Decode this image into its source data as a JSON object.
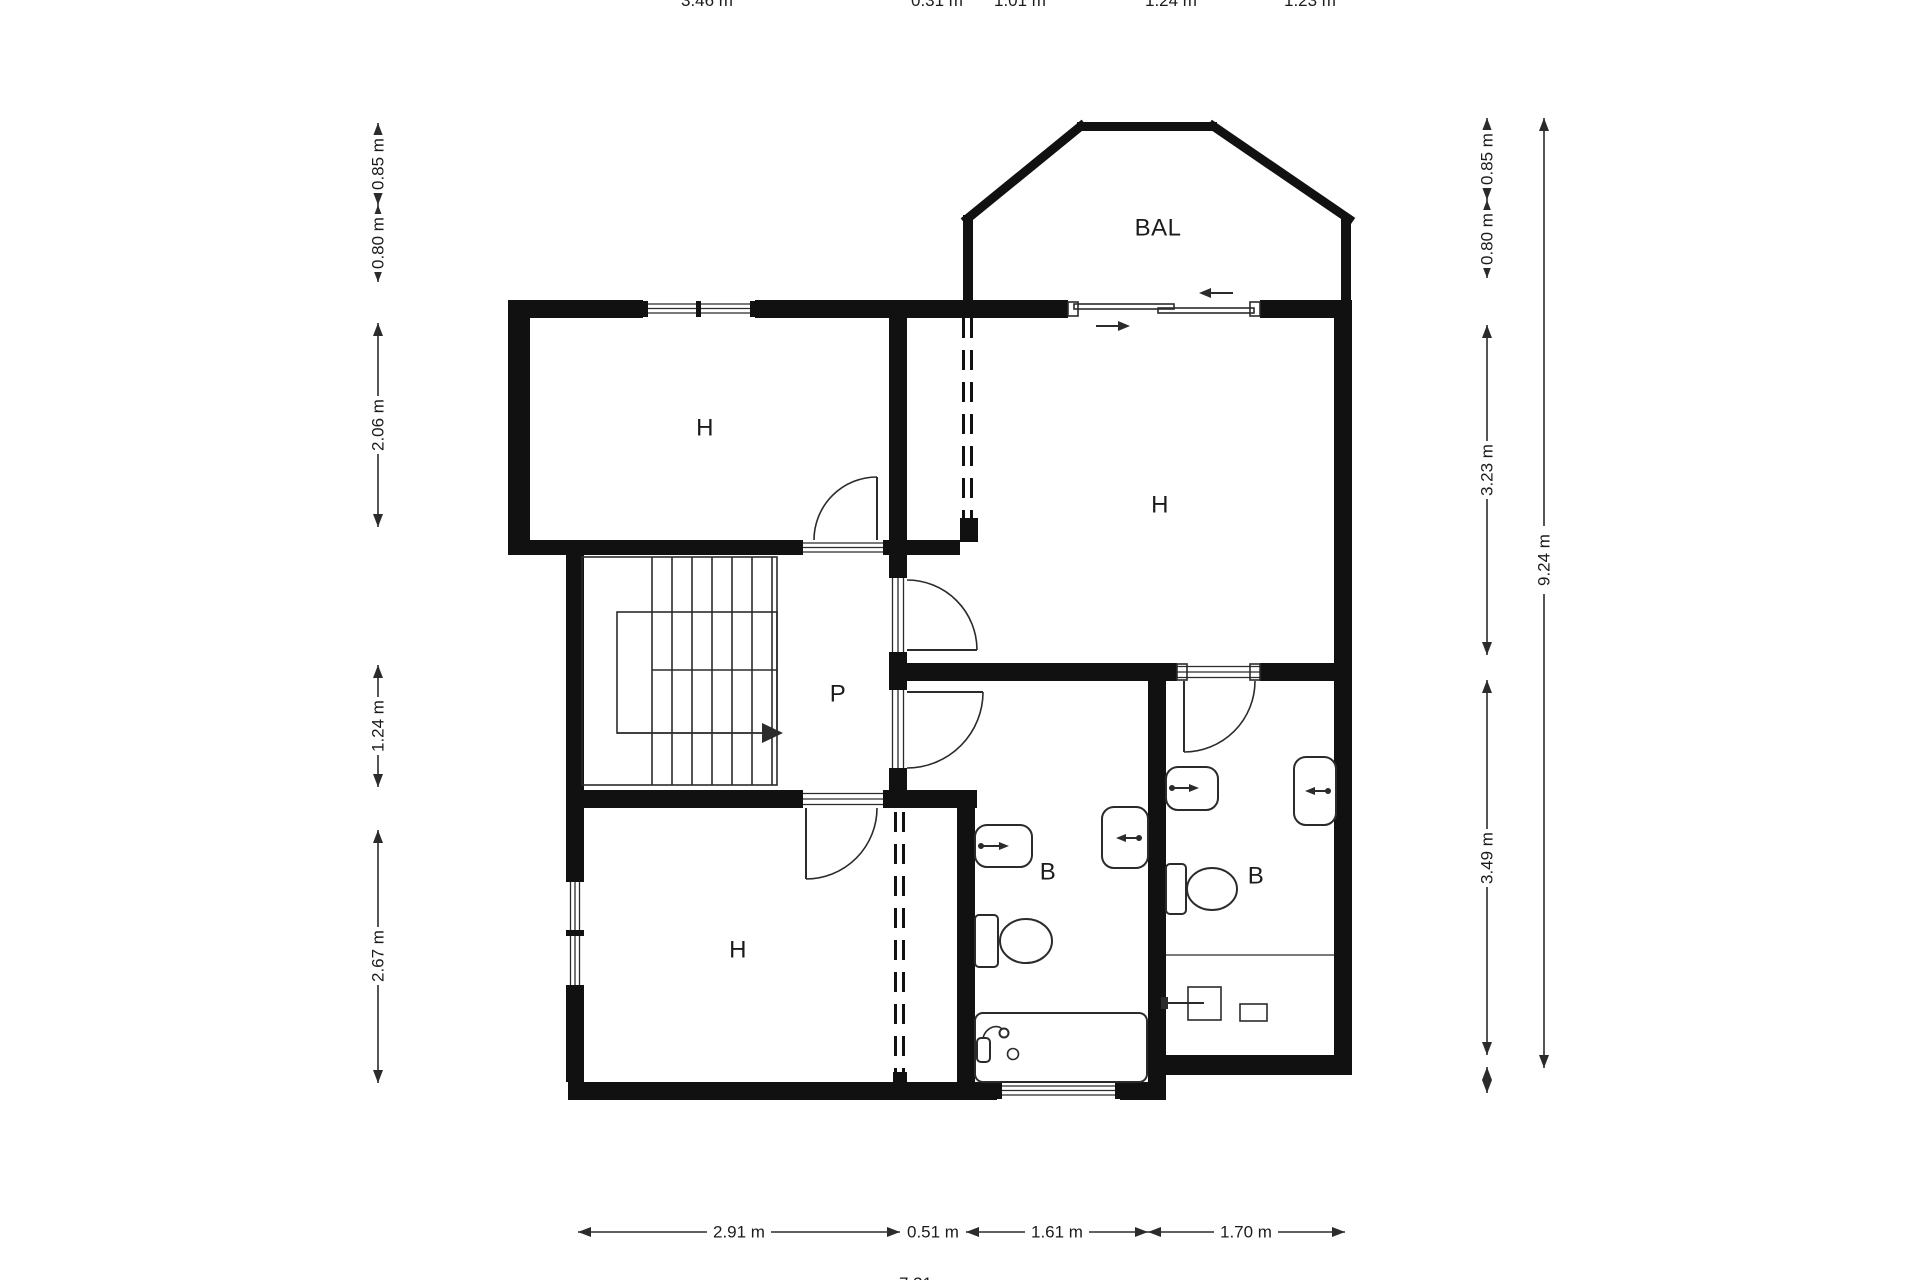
{
  "plan": {
    "rooms": {
      "balcony": "BAL",
      "bedroom_top_left": "H",
      "bedroom_top_right": "H",
      "bedroom_bottom": "H",
      "hallway": "P",
      "bathroom_middle": "B",
      "bathroom_right": "B"
    },
    "dimensions": {
      "left": [
        "0.85 m",
        "0.80 m",
        "2.06 m",
        "1.24 m",
        "2.67 m"
      ],
      "right": [
        "0.85 m",
        "0.80 m",
        "3.23 m",
        "3.49 m"
      ],
      "right_total": "9.24 m",
      "bottom": [
        "2.91 m",
        "0.51 m",
        "1.61 m",
        "1.70 m"
      ],
      "top_cropped": [
        "3.46 m",
        "0.31 m",
        "1.01 m",
        "1.24 m",
        "1.23 m"
      ],
      "bottom_cropped_total": "7.31 m"
    },
    "colors": {
      "wall": "#111111",
      "line": "#2b2b2b",
      "text": "#1b1b1b",
      "background": "#ffffff"
    }
  }
}
